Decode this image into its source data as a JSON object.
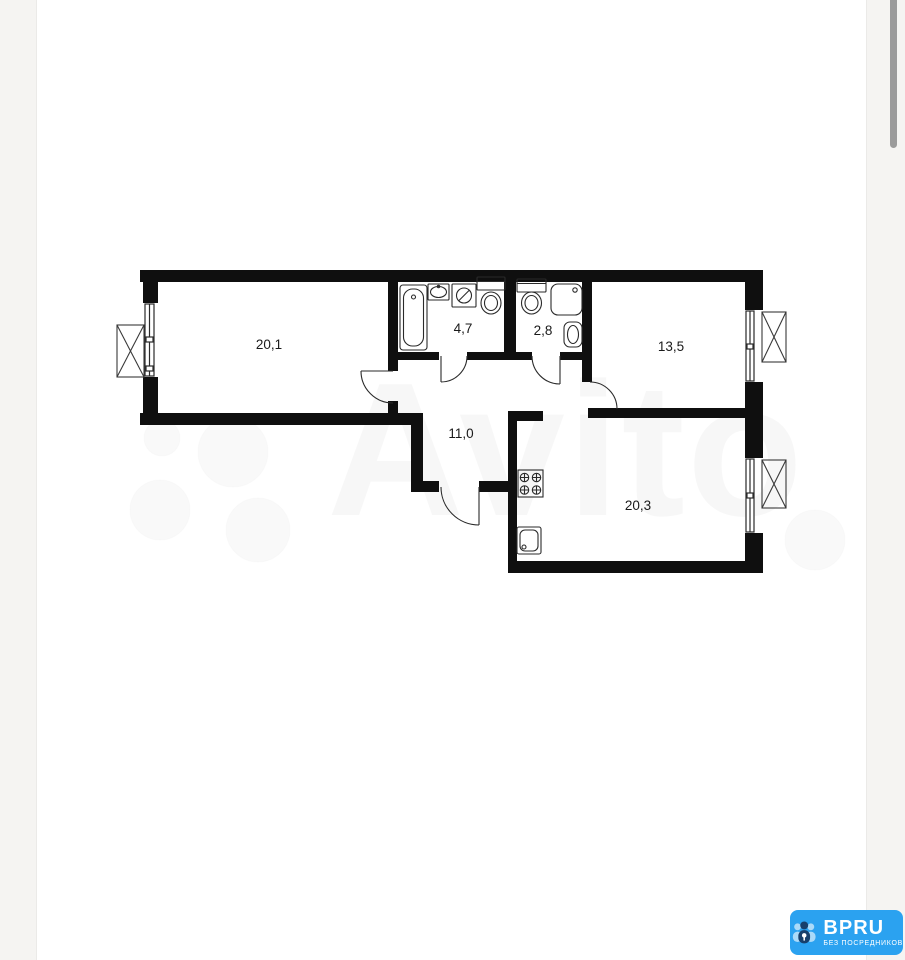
{
  "viewer": {
    "background": "#ffffff",
    "gutter_color": "#f5f4f2",
    "scrollbar_color": "#9b9b9b"
  },
  "watermark": {
    "text": "Avito"
  },
  "floorplan": {
    "wall_color": "#0f0f0f",
    "line_color": "#2a2a2a",
    "rooms": [
      {
        "id": "living-room",
        "area_label": "20,1"
      },
      {
        "id": "bathroom",
        "area_label": "4,7"
      },
      {
        "id": "toilet",
        "area_label": "2,8"
      },
      {
        "id": "bedroom",
        "area_label": "13,5"
      },
      {
        "id": "hallway",
        "area_label": "11,0"
      },
      {
        "id": "kitchen",
        "area_label": "20,3"
      }
    ]
  },
  "badge": {
    "title": "BPRU",
    "subtitle": "БЕЗ ПОСРЕДНИКОВ",
    "background": "#2ba2f0",
    "icon": "people-lock-icon"
  }
}
